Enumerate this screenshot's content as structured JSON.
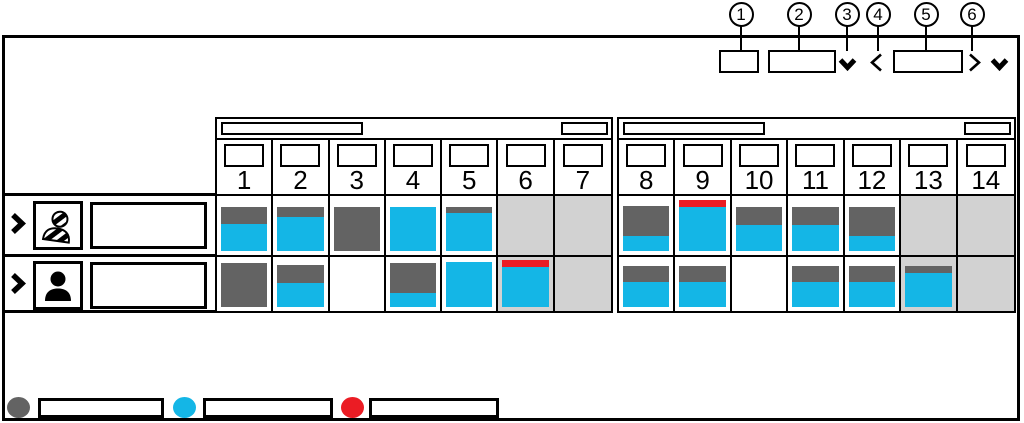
{
  "colors": {
    "dark": "#636363",
    "cyan": "#14B6E6",
    "red": "#EB1C24",
    "weekend": "#D2D2D2",
    "line": "#000000"
  },
  "callouts": {
    "labels": [
      "1",
      "2",
      "3",
      "4",
      "5",
      "6"
    ]
  },
  "toolbar": {
    "small_button_label": "",
    "view_dropdown_value": "",
    "view_dropdown_icon": "chevron-down-icon",
    "prev_arrow": "<",
    "period_selector_value": "",
    "next_arrow": ">",
    "right_dropdown_icon": "chevron-down-icon"
  },
  "timeline": {
    "weeks": [
      {
        "label": "",
        "sublabel": "",
        "days": [
          {
            "n": "1",
            "weekend": false
          },
          {
            "n": "2",
            "weekend": false
          },
          {
            "n": "3",
            "weekend": false
          },
          {
            "n": "4",
            "weekend": false
          },
          {
            "n": "5",
            "weekend": false
          },
          {
            "n": "6",
            "weekend": true
          },
          {
            "n": "7",
            "weekend": true
          }
        ]
      },
      {
        "label": "",
        "sublabel": "",
        "days": [
          {
            "n": "8",
            "weekend": false
          },
          {
            "n": "9",
            "weekend": false
          },
          {
            "n": "10",
            "weekend": false
          },
          {
            "n": "11",
            "weekend": false
          },
          {
            "n": "12",
            "weekend": false
          },
          {
            "n": "13",
            "weekend": true
          },
          {
            "n": "14",
            "weekend": true
          }
        ]
      }
    ]
  },
  "rows": [
    {
      "icon": "striped-person-icon",
      "name": "",
      "cells": [
        [
          [
            "dark",
            17
          ],
          [
            "cyan",
            27
          ]
        ],
        [
          [
            "dark",
            10
          ],
          [
            "cyan",
            34
          ]
        ],
        [
          [
            "dark",
            44
          ]
        ],
        [
          [
            "cyan",
            44
          ]
        ],
        [
          [
            "dark",
            6
          ],
          [
            "cyan",
            38
          ]
        ],
        [],
        [],
        [
          [
            "dark",
            30
          ],
          [
            "cyan",
            15
          ]
        ],
        [
          [
            "red",
            7
          ],
          [
            "cyan",
            44
          ]
        ],
        [
          [
            "dark",
            18
          ],
          [
            "cyan",
            26
          ]
        ],
        [
          [
            "dark",
            18
          ],
          [
            "cyan",
            26
          ]
        ],
        [
          [
            "dark",
            29
          ],
          [
            "cyan",
            15
          ]
        ],
        [],
        []
      ]
    },
    {
      "icon": "person-icon",
      "name": "",
      "cells": [
        [
          [
            "dark",
            44
          ]
        ],
        [
          [
            "dark",
            18
          ],
          [
            "cyan",
            24
          ]
        ],
        [],
        [
          [
            "dark",
            30
          ],
          [
            "cyan",
            14
          ]
        ],
        [
          [
            "cyan",
            45
          ]
        ],
        [
          [
            "red",
            7
          ],
          [
            "cyan",
            40
          ]
        ],
        [],
        [
          [
            "dark",
            16
          ],
          [
            "cyan",
            25
          ]
        ],
        [
          [
            "dark",
            16
          ],
          [
            "cyan",
            25
          ]
        ],
        [],
        [
          [
            "dark",
            16
          ],
          [
            "cyan",
            25
          ]
        ],
        [
          [
            "dark",
            16
          ],
          [
            "cyan",
            25
          ]
        ],
        [
          [
            "dark",
            7
          ],
          [
            "cyan",
            34
          ]
        ],
        []
      ]
    }
  ],
  "legend": [
    {
      "color": "dark",
      "label": ""
    },
    {
      "color": "cyan",
      "label": ""
    },
    {
      "color": "red",
      "label": ""
    }
  ]
}
